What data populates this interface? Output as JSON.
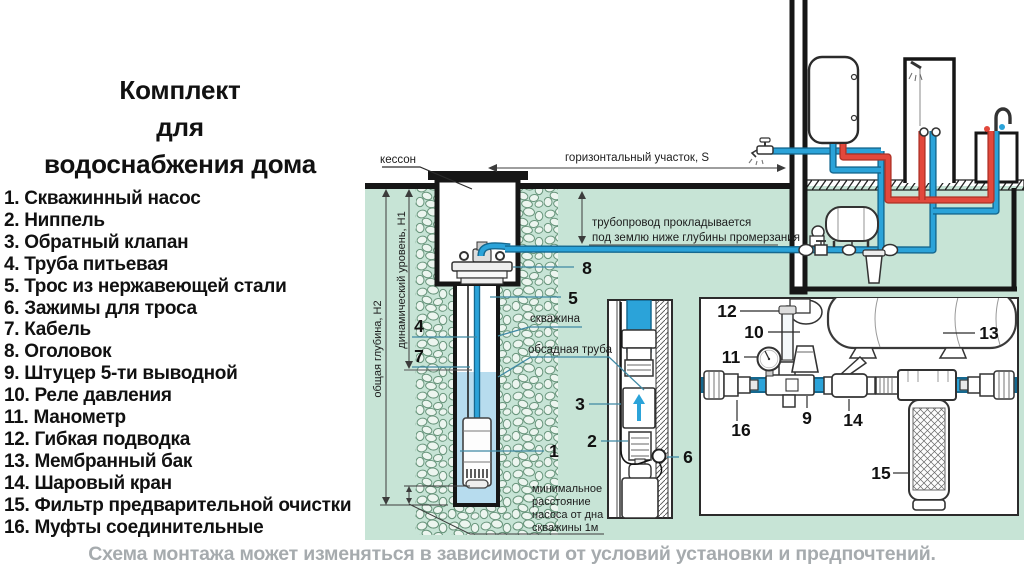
{
  "title": {
    "line1": "Комплект",
    "line2": "для",
    "line3": "водоснабжения дома"
  },
  "parts_list": [
    "1. Скважинный насос",
    "2. Ниппель",
    "3. Обратный клапан",
    "4. Труба питьевая",
    "5. Трос из нержавеющей стали",
    "6. Зажимы для троса",
    "7. Кабель",
    "8. Оголовок",
    "9. Штуцер 5-ти выводной",
    "10. Реле давления",
    "11. Манометр",
    "12. Гибкая подводка",
    "13. Мембранный бак",
    "14. Шаровый кран",
    "15. Фильтр предварительной очистки",
    "16. Муфты соединительные"
  ],
  "diagram": {
    "kesson": "кессон",
    "horizontal_section": "горизонтальный участок, S",
    "freeze_note_1": "трубопровод прокладывается",
    "freeze_note_2": "под землю ниже глубины промерзания",
    "total_depth": "общая глубина, Н2",
    "dynamic_level": "динамический уровень, Н1",
    "well_label": "скважина",
    "casing_label": "обсадная труба",
    "min_dist_1": "минимальное",
    "min_dist_2": "расстояние",
    "min_dist_3": "насоса от дна",
    "min_dist_4": "скважины 1м",
    "n1": "1",
    "n2": "2",
    "n3": "3",
    "n4": "4",
    "n5": "5",
    "n6": "6",
    "n7": "7",
    "n8": "8",
    "n9": "9",
    "n10": "10",
    "n11": "11",
    "n12": "12",
    "n13": "13",
    "n14": "14",
    "n15": "15",
    "n16": "16"
  },
  "caption": "Схема монтажа может изменяться в зависимости от условий установки и предпочтений.",
  "colors": {
    "ground": "#c7e4d6",
    "blue": "#2ba3d9",
    "blued": "#15688f",
    "red": "#e2483c",
    "redd": "#b23428",
    "water": "#b7dcee",
    "pebble": "#69957c",
    "caption": "#a6abae"
  }
}
